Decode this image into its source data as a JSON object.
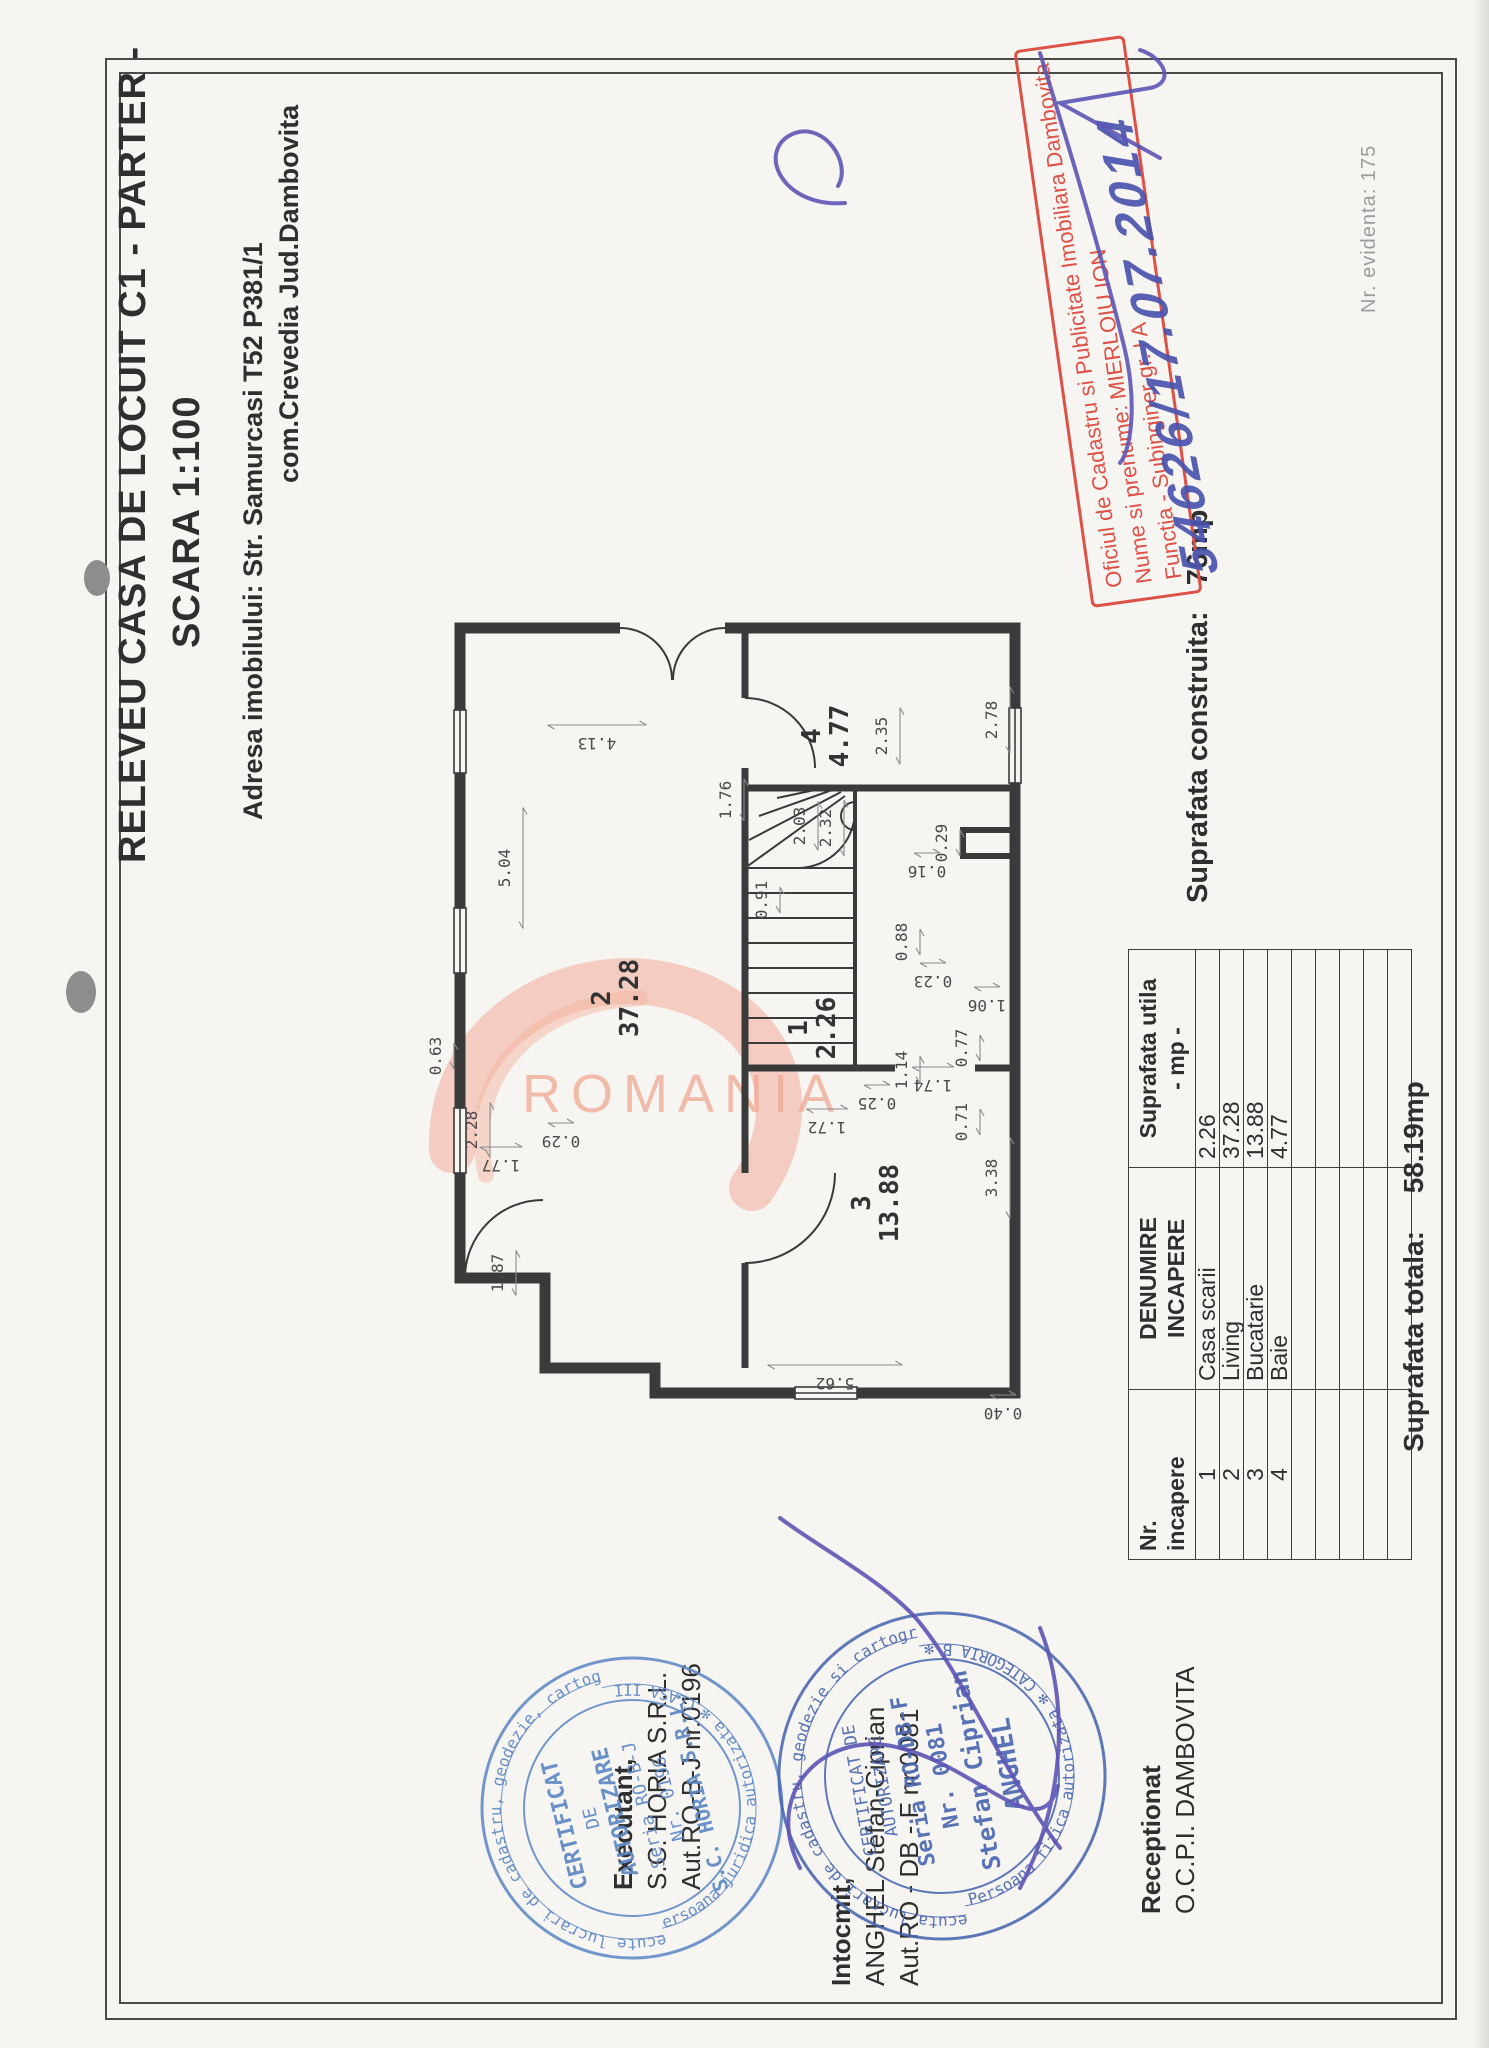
{
  "document": {
    "title_line1": "RELEVEU CASA DE LOCUIT C1 - PARTER -",
    "title_line2": "SCARA 1:100",
    "address_line1": "Adresa imobilului: Str. Samurcasi T52 P381/1",
    "address_line2": "com.Crevedia  Jud.Dambovita",
    "built_area_label": "Suprafata construita:",
    "built_area_value": "76mp",
    "total_area_label": "Suprafata totala:",
    "total_area_value": "58.19mp",
    "registry_note": "Nr. evidenta: 175",
    "watermark_text": "ROMANIA"
  },
  "table": {
    "header": {
      "col1_line1": "Nr.",
      "col1_line2": "incapere",
      "col2_line1": "DENUMIRE",
      "col2_line2": "INCAPERE",
      "col3_line1": "Suprafata utila",
      "col3_line2": "- mp -"
    },
    "rows": [
      {
        "nr": "1",
        "name": "Casa scarii",
        "area": "2.26"
      },
      {
        "nr": "2",
        "name": "Living",
        "area": "37.28"
      },
      {
        "nr": "3",
        "name": "Bucatarie",
        "area": "13.88"
      },
      {
        "nr": "4",
        "name": "Baie",
        "area": "4.77"
      }
    ],
    "empty_row_count": 5
  },
  "plan": {
    "rooms": [
      {
        "no": "2",
        "area": "37.28",
        "x": 430,
        "y": 195
      },
      {
        "no": "1",
        "area": "2.26",
        "x": 400,
        "y": 392
      },
      {
        "no": "3",
        "area": "13.88",
        "x": 225,
        "y": 455
      },
      {
        "no": "4",
        "area": "4.77",
        "x": 692,
        "y": 405
      }
    ],
    "dims": [
      {
        "t": "1.87",
        "x": 155,
        "y": 88,
        "o": "h"
      },
      {
        "t": "2.28",
        "x": 298,
        "y": 62,
        "o": "h"
      },
      {
        "t": "0.63",
        "x": 372,
        "y": 26,
        "o": "h"
      },
      {
        "t": "1.77",
        "x": 268,
        "y": 86,
        "o": "v"
      },
      {
        "t": "0.29",
        "x": 292,
        "y": 146,
        "o": "v"
      },
      {
        "t": "5.04",
        "x": 560,
        "y": 95,
        "o": "h"
      },
      {
        "t": "4.13",
        "x": 690,
        "y": 182,
        "o": "v"
      },
      {
        "t": "5.62",
        "x": 50,
        "y": 420,
        "o": "v"
      },
      {
        "t": "3.38",
        "x": 250,
        "y": 582,
        "o": "h"
      },
      {
        "t": "0.40",
        "x": 20,
        "y": 588,
        "o": "v"
      },
      {
        "t": "0.29",
        "x": 585,
        "y": 532,
        "o": "h"
      },
      {
        "t": "2.78",
        "x": 708,
        "y": 582,
        "o": "h"
      },
      {
        "t": "1.06",
        "x": 428,
        "y": 572,
        "o": "v"
      },
      {
        "t": "0.77",
        "x": 380,
        "y": 552,
        "o": "h"
      },
      {
        "t": "0.71",
        "x": 306,
        "y": 552,
        "o": "h"
      },
      {
        "t": "1.74",
        "x": 348,
        "y": 518,
        "o": "v"
      },
      {
        "t": "1.14",
        "x": 358,
        "y": 492,
        "o": "h"
      },
      {
        "t": "0.23",
        "x": 452,
        "y": 518,
        "o": "v"
      },
      {
        "t": "0.88",
        "x": 486,
        "y": 492,
        "o": "h"
      },
      {
        "t": "0.25",
        "x": 330,
        "y": 462,
        "o": "v"
      },
      {
        "t": "1.72",
        "x": 306,
        "y": 412,
        "o": "v"
      },
      {
        "t": "0.91",
        "x": 528,
        "y": 352,
        "o": "h"
      },
      {
        "t": "0.16",
        "x": 562,
        "y": 512,
        "o": "v"
      },
      {
        "t": "1.76",
        "x": 628,
        "y": 316,
        "o": "h"
      },
      {
        "t": "2.03",
        "x": 602,
        "y": 390,
        "o": "h"
      },
      {
        "t": "2.32",
        "x": 600,
        "y": 416,
        "o": "h"
      },
      {
        "t": "2.35",
        "x": 692,
        "y": 472,
        "o": "h"
      }
    ]
  },
  "red_stamp": {
    "line1": "Oficiul de Cadastru si Publicitate Imobiliara Dambovita",
    "line2": "Nume si prenume: MIERLOIU ION",
    "line3": "Functia - Subinginer gr. I A",
    "handwritten": "54626/17.07.2014"
  },
  "blocks": {
    "executant_line1": "Executant,",
    "executant_line2": "S.C. HORIA S.R.L.",
    "executant_line3": "Aut.RO-B-J nr.0196",
    "intocmit_line1": "Intocmit,",
    "intocmit_line2": "ANGHEL  Stefan-Ciprian",
    "intocmit_line3": "Aut.RO - DB - F nr.0081",
    "receptionat_line1": "Receptionat",
    "receptionat_line2": "O.C.P.I. DAMBOVITA"
  },
  "stamp_executant": {
    "ring_top": "sa execute lucrari de cadastru, geodezie, cartografie",
    "ring_bottom": "Persoana juridica autorizata ✻ CLASA III ✻",
    "center_lines": [
      "CERTIFICAT",
      "DE",
      "AUTORIZARE",
      "Seria RO-B-J",
      "Nr. 0196",
      "S.C. HORIA S.R.L."
    ]
  },
  "stamp_intocmit": {
    "ring_top": "a executa lucrari de cadastru, geodezie si cartografie",
    "ring_bottom": "Persoana fizica autorizata ✻ CATEGORIA B ✻",
    "center_lines": [
      "CERTIFICAT DE",
      "AUTORIZARE",
      "Seria RO-DB-F",
      "Nr. 0081",
      "Stefan Ciprian",
      "ANGHEL"
    ]
  },
  "colors": {
    "paper": "#f6f5f2",
    "ink": "#2f2f2f",
    "plan_line": "#3a3a3a",
    "dim_text": "#4a4a4a",
    "stamp_red": "#dd5146",
    "pen_blue": "#4a54ae",
    "stamp_blue_executant": "#5b86c4",
    "stamp_blue_intocmit": "#4a67b0",
    "watermark_orange": "#f0a893",
    "punch_hole": "#8d8d8d"
  }
}
